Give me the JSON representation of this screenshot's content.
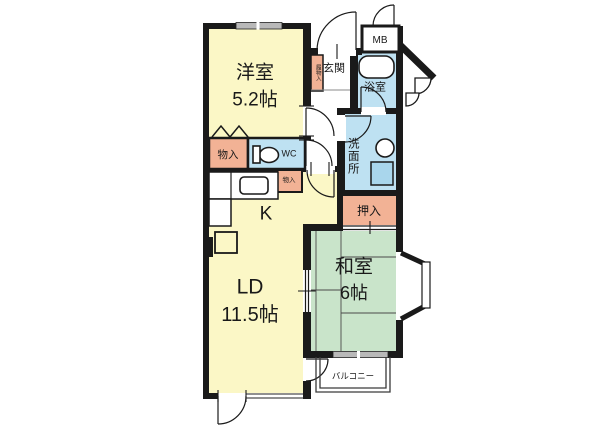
{
  "rooms": {
    "western_room": {
      "name": "洋室",
      "size": "5.2帖"
    },
    "living_dining": {
      "name": "LD",
      "size": "11.5帖"
    },
    "kitchen": {
      "name": "K"
    },
    "japanese_room": {
      "name": "和室",
      "size": "6帖"
    },
    "entrance": {
      "name": "玄関"
    },
    "bathroom": {
      "name": "浴室"
    },
    "washroom": {
      "name": "洗面所"
    },
    "wc": {
      "name": "WC"
    },
    "closet": {
      "name": "押入"
    },
    "storage_west": {
      "name": "物入"
    },
    "storage_hall": {
      "name": "物入"
    },
    "shoe_storage": {
      "name": "履物入"
    },
    "meter_box": {
      "name": "MB"
    },
    "balcony": {
      "name": "バルコニー"
    }
  },
  "fixtures": [
    "bathtub",
    "toilet",
    "washbasin",
    "washing-machine",
    "kitchen-sink",
    "refrigerator-space"
  ],
  "colors": {
    "wall": "#1a1a1a",
    "room_yellow": "#FBF7C6",
    "tatami_green": "#C9E4CA",
    "water_blue": "#BEE1F2",
    "basin_blue": "#A9D6EC",
    "storage_salmon": "#F2B295",
    "window_gray": "#B9B9B9",
    "background": "#FFFFFF"
  }
}
